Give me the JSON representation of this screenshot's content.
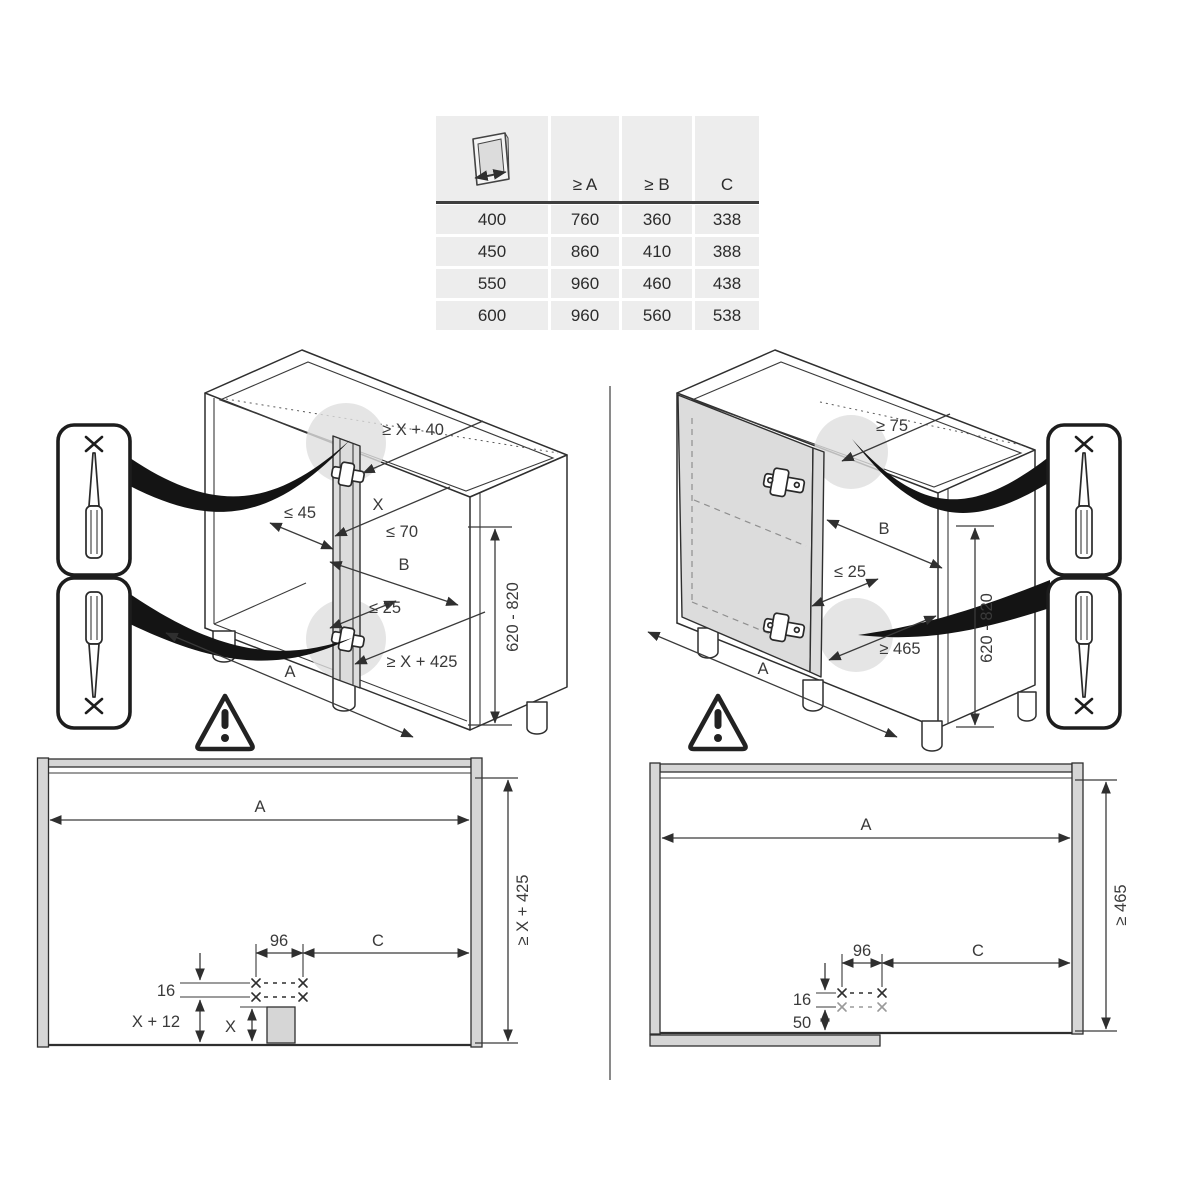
{
  "table": {
    "col_headers": [
      "≥ A",
      "≥ B",
      "C"
    ],
    "rows": [
      [
        "400",
        "760",
        "360",
        "338"
      ],
      [
        "450",
        "860",
        "410",
        "388"
      ],
      [
        "550",
        "960",
        "460",
        "438"
      ],
      [
        "600",
        "960",
        "560",
        "538"
      ]
    ]
  },
  "left_cabinet": {
    "dims": {
      "top_clearance": "≥ X + 40",
      "x": "X",
      "max45": "≤ 45",
      "max70": "≤ 70",
      "b": "B",
      "max25": "≤ 25",
      "bottom_clearance": "≥ X + 425",
      "a": "A",
      "height_range": "620 - 820"
    }
  },
  "right_cabinet": {
    "dims": {
      "top_clearance": "≥ 75",
      "b": "B",
      "max25": "≤ 25",
      "bottom_clearance": "≥ 465",
      "a": "A",
      "height_range": "620 - 820"
    }
  },
  "bottom_left_view": {
    "dims": {
      "a": "A",
      "height": "≥ X + 425",
      "hole_spacing": "96",
      "c": "C",
      "row_gap": "16",
      "bottom_offset": "X + 12",
      "x": "X"
    }
  },
  "bottom_right_view": {
    "dims": {
      "a": "A",
      "height": "≥ 465",
      "hole_spacing": "96",
      "c": "C",
      "row_gap": "16",
      "bottom_offset": "50"
    }
  },
  "colors": {
    "line": "#2f2f2f",
    "panel_gray": "#dcdcdc",
    "table_bg": "#ededed"
  }
}
